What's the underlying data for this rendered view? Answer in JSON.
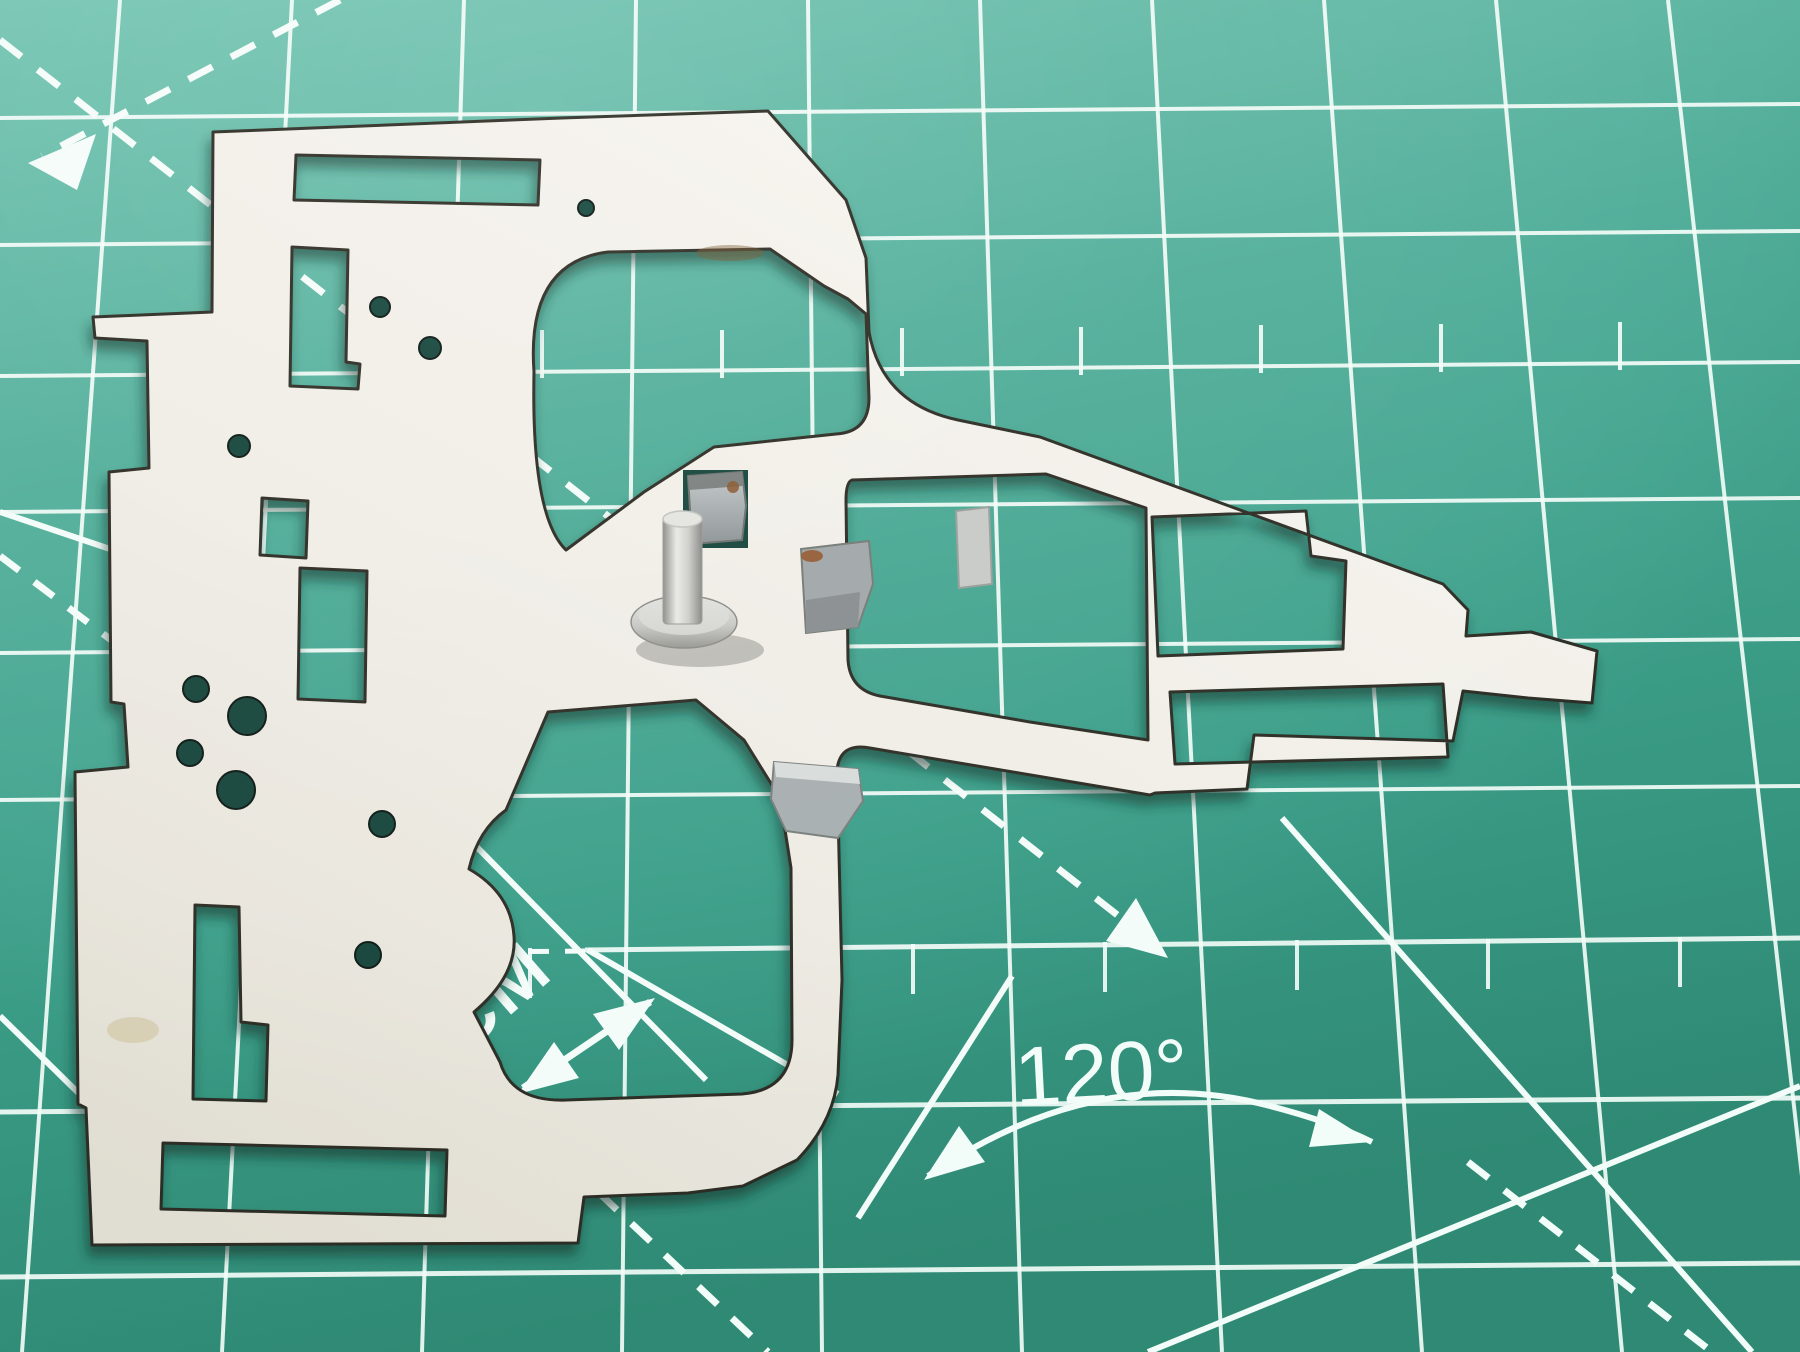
{
  "scene": {
    "subject": "stamped sheet-metal plate with standing cylindrical pin on a green self-healing cutting mat",
    "camera": "slight perspective from above"
  },
  "mat": {
    "labels": {
      "one_cm": "1CM",
      "angle": "120°"
    },
    "colors": {
      "surface_light": "#74c2b1",
      "surface": "#4aa995",
      "surface_dark": "#35907b",
      "marking": "#f4fcf9"
    },
    "features": [
      "square grid lines",
      "half-cell tick marks",
      "dashed diagonal guide lines with arrowheads",
      "solid angle rays",
      "angle arc with arrowheads",
      "1CM spacing callout with double-headed arrow",
      "120 degree angle label"
    ]
  },
  "plate": {
    "material": "nickel-plated stamped steel",
    "colors": {
      "surface": "#f2efe9",
      "surface_shaded": "#e6e2d9",
      "cut_edge": "#32312a",
      "bent_tab": "#a6acae",
      "pin_metal": "#c9c9c6",
      "rust": "#91572c"
    },
    "features": [
      "large top window with chamfered corner",
      "keyhole-shaped bottom window",
      "two right-arm windows",
      "long slots and round holes",
      "three bent tabs",
      "riveted pin with flange",
      "right-side tab extension"
    ]
  }
}
